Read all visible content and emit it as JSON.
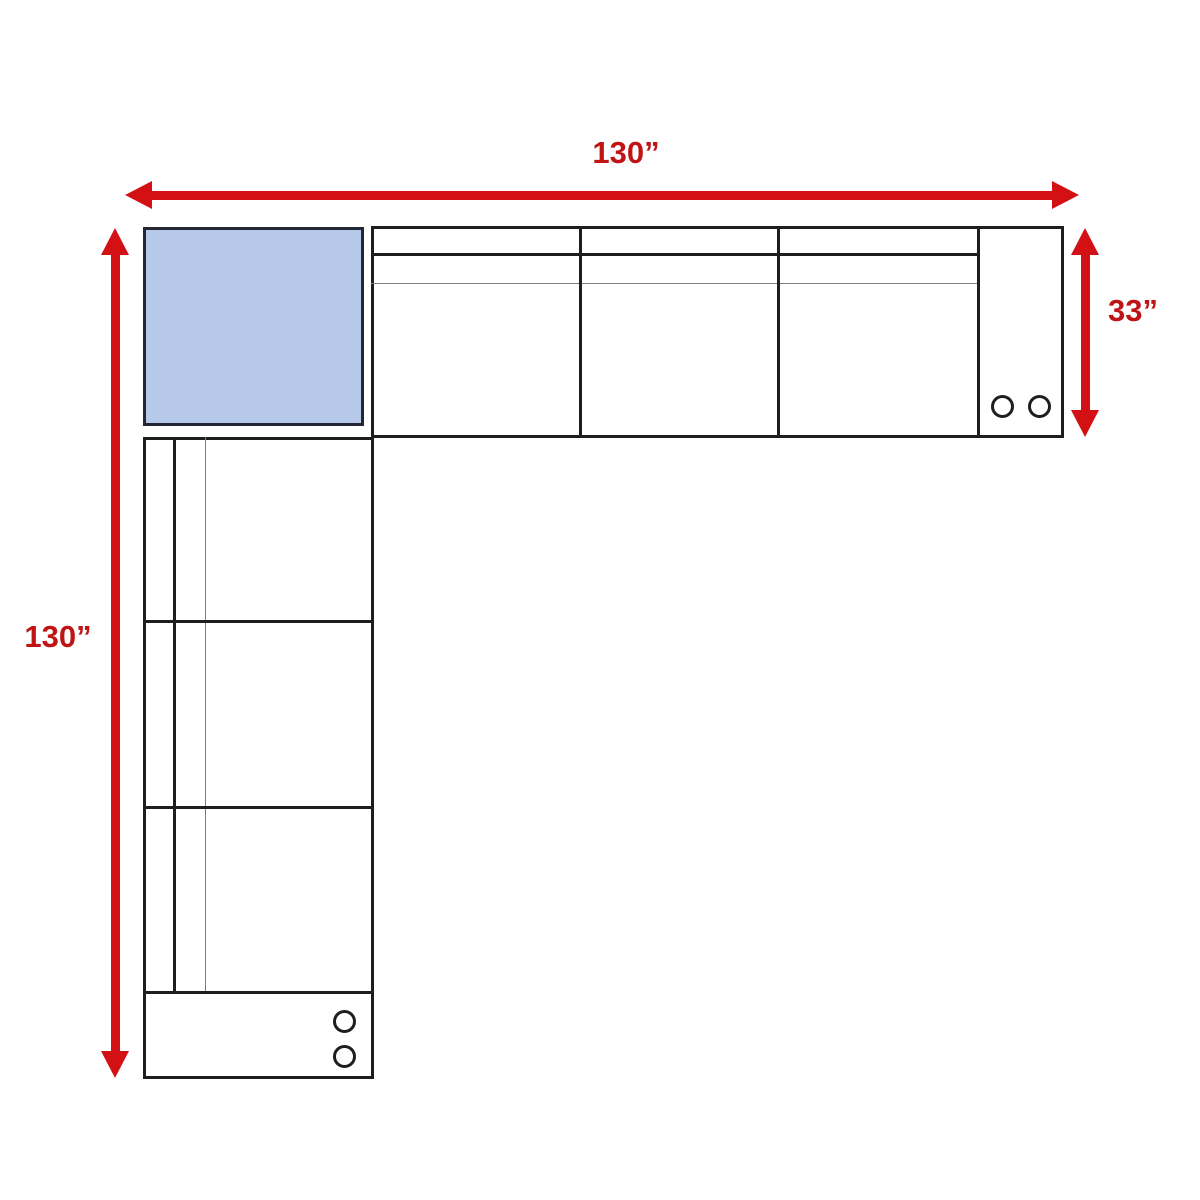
{
  "diagram": {
    "name": "sectional-sofa-dimension-diagram",
    "dimensions": {
      "top": {
        "label": "130”",
        "value": 130,
        "unit": "inches"
      },
      "left": {
        "label": "130”",
        "value": 130,
        "unit": "inches"
      },
      "right": {
        "label": "33”",
        "value": 33,
        "unit": "inches"
      }
    },
    "pieces": {
      "corner": {
        "name": "corner piece",
        "fill": "#b7c9e8"
      },
      "horizontal_sofa": {
        "seat_count": 3,
        "end_circles": 2
      },
      "vertical_sofa": {
        "seat_count": 3,
        "end_circles": 2
      }
    }
  },
  "colors": {
    "arrow_red": "#d31114",
    "label_red": "#c01414",
    "line_dark": "#1e1e1e",
    "line_gray": "#7d7d7d",
    "corner_fill": "#b7c9e8",
    "bg": "#ffffff"
  }
}
